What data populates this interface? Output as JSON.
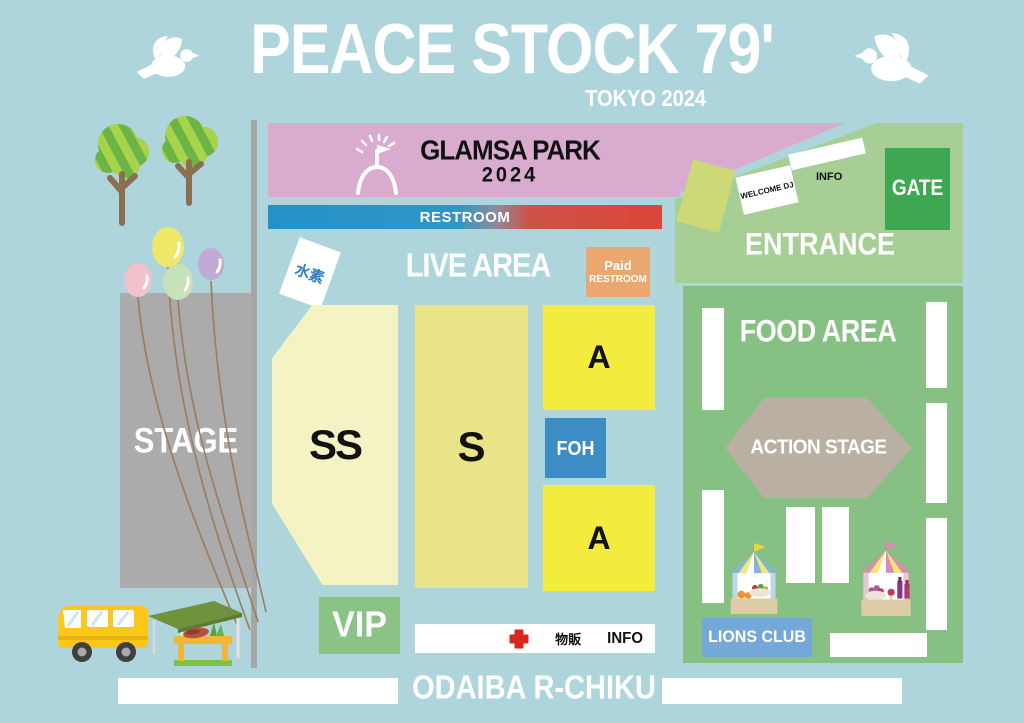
{
  "header": {
    "title": "PEACE STOCK 79'",
    "subtitle": "TOKYO 2024",
    "left_icon": "dove",
    "right_icon": "dove"
  },
  "park_banner": {
    "title": "GLAMSA PARK",
    "year": "2024",
    "icon": "gate-flag",
    "color": "#d9accf"
  },
  "restroom_bar": {
    "label": "RESTROOM",
    "color_left": "#2591c6",
    "color_right": "#dc4639"
  },
  "stage": {
    "label": "STAGE",
    "color": "#ababab"
  },
  "live_area": {
    "label": "LIVE AREA",
    "water_sign": "水素",
    "paid_restroom": {
      "line1": "Paid",
      "line2": "RESTROOM",
      "color": "#eba770"
    },
    "blocks": [
      {
        "id": "ss",
        "label": "SS",
        "color": "#f5f2c4"
      },
      {
        "id": "s",
        "label": "S",
        "color": "#ebe388"
      },
      {
        "id": "a-upper",
        "label": "A",
        "color": "#f3eb3d"
      },
      {
        "id": "foh",
        "label": "FOH",
        "color": "#3c8dc5"
      },
      {
        "id": "a-lower",
        "label": "A",
        "color": "#f3eb3d"
      },
      {
        "id": "vip",
        "label": "VIP",
        "color": "#8bc285"
      }
    ],
    "service_bar": {
      "cross_icon": "first-aid-cross",
      "merch": "物販",
      "info": "INFO"
    }
  },
  "entrance": {
    "label": "ENTRANCE",
    "gate_label": "GATE",
    "welcome_dj_label": "WELCOME DJ",
    "info_label": "INFO",
    "color": "#a7cf95",
    "gate_color": "#3ea751"
  },
  "food_area": {
    "label": "FOOD AREA",
    "action_stage_label": "ACTION STAGE",
    "lions_club_label": "LIONS CLUB",
    "color": "#87c083",
    "action_stage_color": "#b9b0a3",
    "lions_club_color": "#74a8d8",
    "stall_icons": [
      "food-stall-tent",
      "drink-stall-tent"
    ]
  },
  "footer": {
    "label": "ODAIBA R-CHIKU"
  },
  "decorations": {
    "icons": [
      "dove",
      "tree",
      "balloons",
      "bus",
      "market-stall"
    ],
    "background_color": "#aed5dc"
  }
}
